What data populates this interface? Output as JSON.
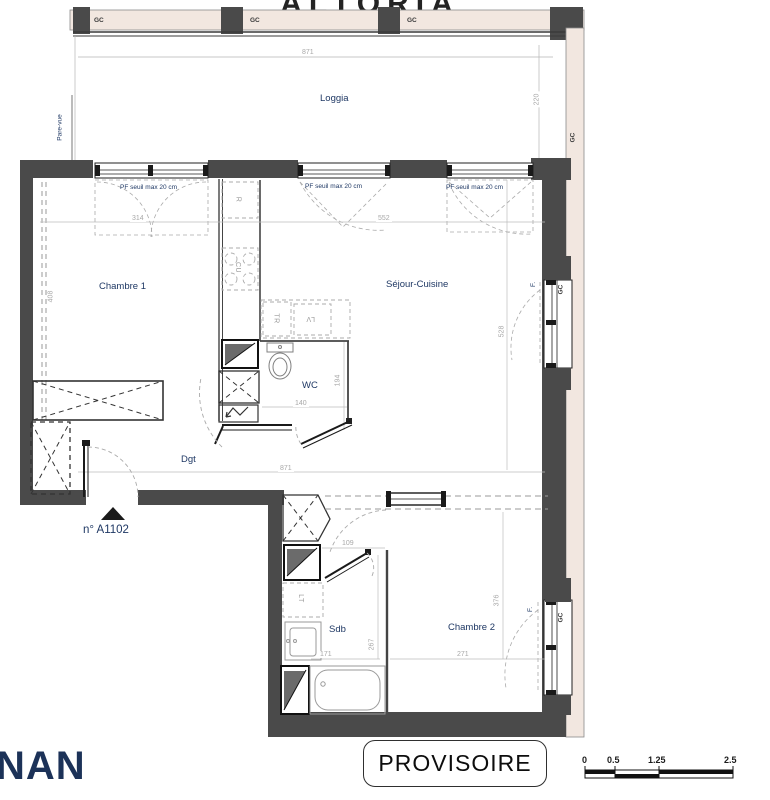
{
  "title": {
    "partial": "ALTORIA"
  },
  "plan": {
    "rooms": {
      "loggia": "Loggia",
      "chambre1": "Chambre 1",
      "sejour": "Séjour-Cuisine",
      "wc": "WC",
      "dgt": "Dgt",
      "sdb": "Sdb",
      "chambre2": "Chambre 2"
    },
    "unit_label": "n° A1102",
    "window_note": "PF seuil max 20 cm",
    "pare_vue": "Pare-vue",
    "gc": "GC",
    "f_label": "F.",
    "appliances": {
      "fridge": "R",
      "hob": "CU",
      "tr": "TR",
      "dishwasher": "LV",
      "washer": "LT"
    },
    "dimensions": {
      "loggia_width": "871",
      "loggia_depth": "220",
      "chambre1_width": "314",
      "sejour_width": "552",
      "chambre1_depth": "408",
      "sejour_depth": "528",
      "wc_depth": "194",
      "wc_width": "140",
      "corridor_width": "871",
      "sdb_door": "109",
      "sdb_width": "171",
      "sdb_depth": "267",
      "chambre2_width": "271",
      "chambre2_depth": "376"
    }
  },
  "stamp": {
    "label": "PROVISOIRE"
  },
  "logo": {
    "partial": "NAN"
  },
  "scalebar": {
    "t0": "0",
    "t1": "0.5",
    "t2": "1.25",
    "t3": "2.5"
  },
  "colors": {
    "wall": "#4a4a4a",
    "facade_strip": "#f2e7e0",
    "label_navy": "#1f3864",
    "dim_gray": "#a8a8a8"
  }
}
